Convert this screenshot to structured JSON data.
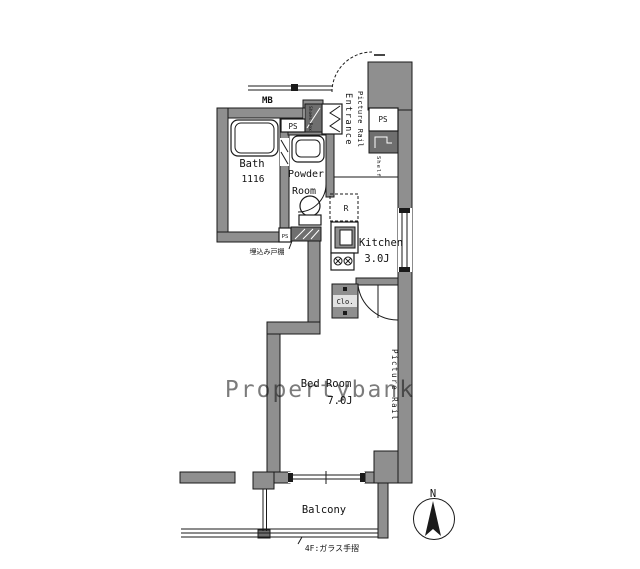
{
  "title": "apartment-floor-plan",
  "colors": {
    "wall": "#8f8f8f",
    "dark_fixture": "#6f6f6f",
    "line": "#1a1a1a",
    "watermark": "#cccccc",
    "background": "#ffffff"
  },
  "labels": {
    "mb": "MB",
    "ps_top": "PS",
    "ps_right": "PS",
    "ps_small": "PS",
    "shoes_box": "Shoes Box",
    "entrance": "Entrance",
    "picture_rail_entrance": "Picture Rail",
    "shelf": "Shelf",
    "bath": "Bath",
    "bath_size": "1116",
    "powder_1": "Powder",
    "powder_2": "Room",
    "fridge": "R",
    "kitchen": "Kitchen",
    "kitchen_size": "3.0J",
    "closet": "Clo.",
    "cupboard_note": "埋込み戸棚",
    "bedroom": "Bed Room",
    "bedroom_size": "7.0J",
    "picture_rail_bedroom": "Picture Rail",
    "balcony": "Balcony",
    "railing_note": "4F:ガラス手摺",
    "north": "N"
  },
  "watermark": "Propertybank"
}
